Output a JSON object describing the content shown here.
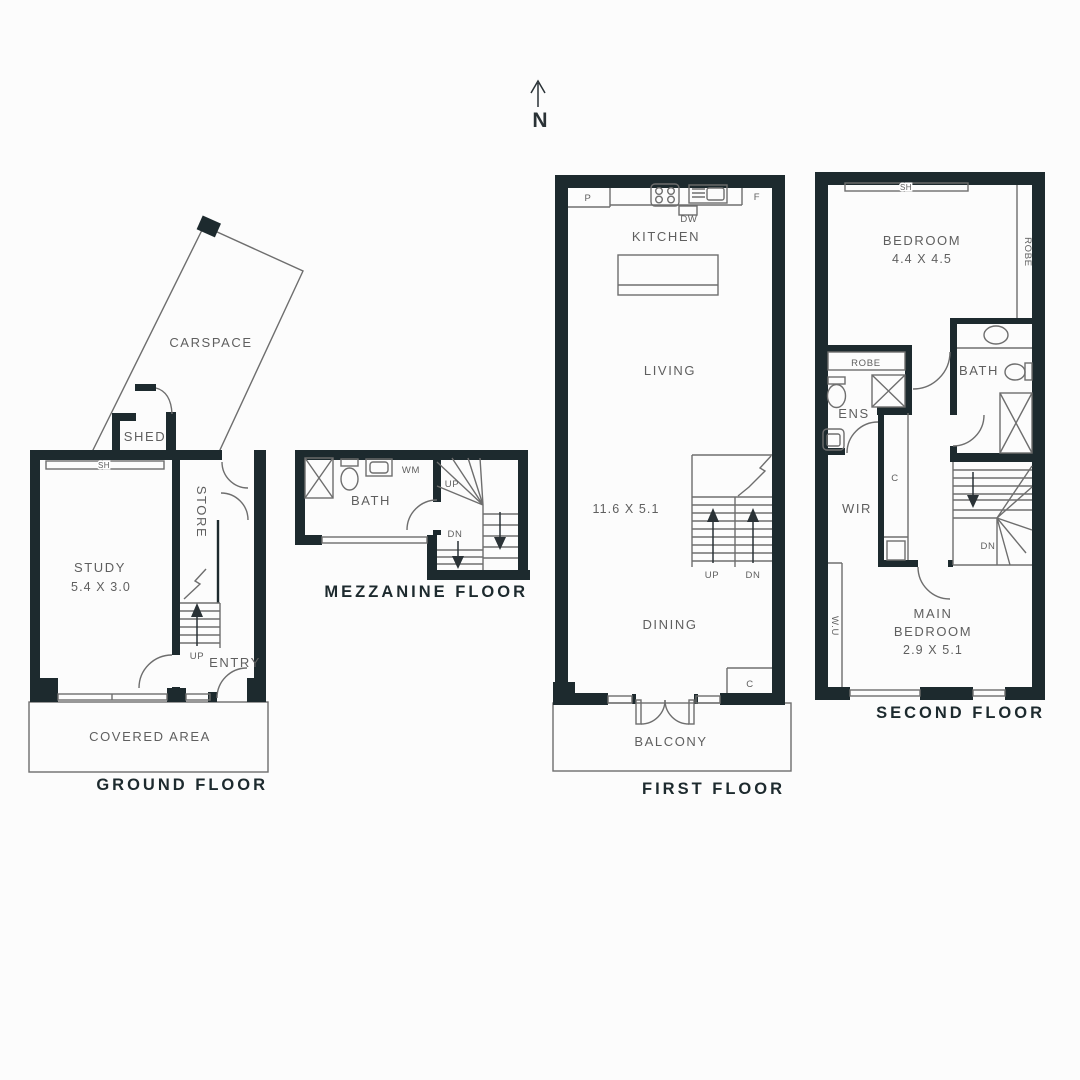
{
  "colors": {
    "bg": "#fcfcfc",
    "wall": "#1d2a2e",
    "line": "#6e6e6e",
    "label": "#5f5f5f",
    "title": "#1d2a2e",
    "arrow": "#2a3236"
  },
  "compass": {
    "north": "N"
  },
  "ground": {
    "title": "GROUND FLOOR",
    "labels": {
      "carspace": "CARSPACE",
      "shed": "SHED",
      "sh": "SH",
      "study": "STUDY",
      "study_dim": "5.4 X 3.0",
      "store": "STORE",
      "up": "UP",
      "entry": "ENTRY",
      "covered_area": "COVERED AREA"
    }
  },
  "mezzanine": {
    "title": "MEZZANINE FLOOR",
    "labels": {
      "bath": "BATH",
      "wm": "WM",
      "up": "UP",
      "dn": "DN"
    }
  },
  "first": {
    "title": "FIRST FLOOR",
    "labels": {
      "pantry": "P",
      "fridge": "F",
      "dishwasher": "DW",
      "kitchen": "KITCHEN",
      "living": "LIVING",
      "living_dim": "11.6 X 5.1",
      "up": "UP",
      "dn": "DN",
      "dining": "DINING",
      "cupboard": "C",
      "balcony": "BALCONY"
    }
  },
  "second": {
    "title": "SECOND FLOOR",
    "labels": {
      "sh": "SH",
      "bedroom": "BEDROOM",
      "bedroom_dim": "4.4 X 4.5",
      "robe_side": "ROBE",
      "robe_box": "ROBE",
      "ens": "ENS",
      "bath": "BATH",
      "cupboard": "C",
      "wir": "WIR",
      "dn": "DN",
      "wu": "W.U",
      "main_line1": "MAIN",
      "main_line2": "BEDROOM",
      "main_dim": "2.9 X 5.1"
    }
  }
}
